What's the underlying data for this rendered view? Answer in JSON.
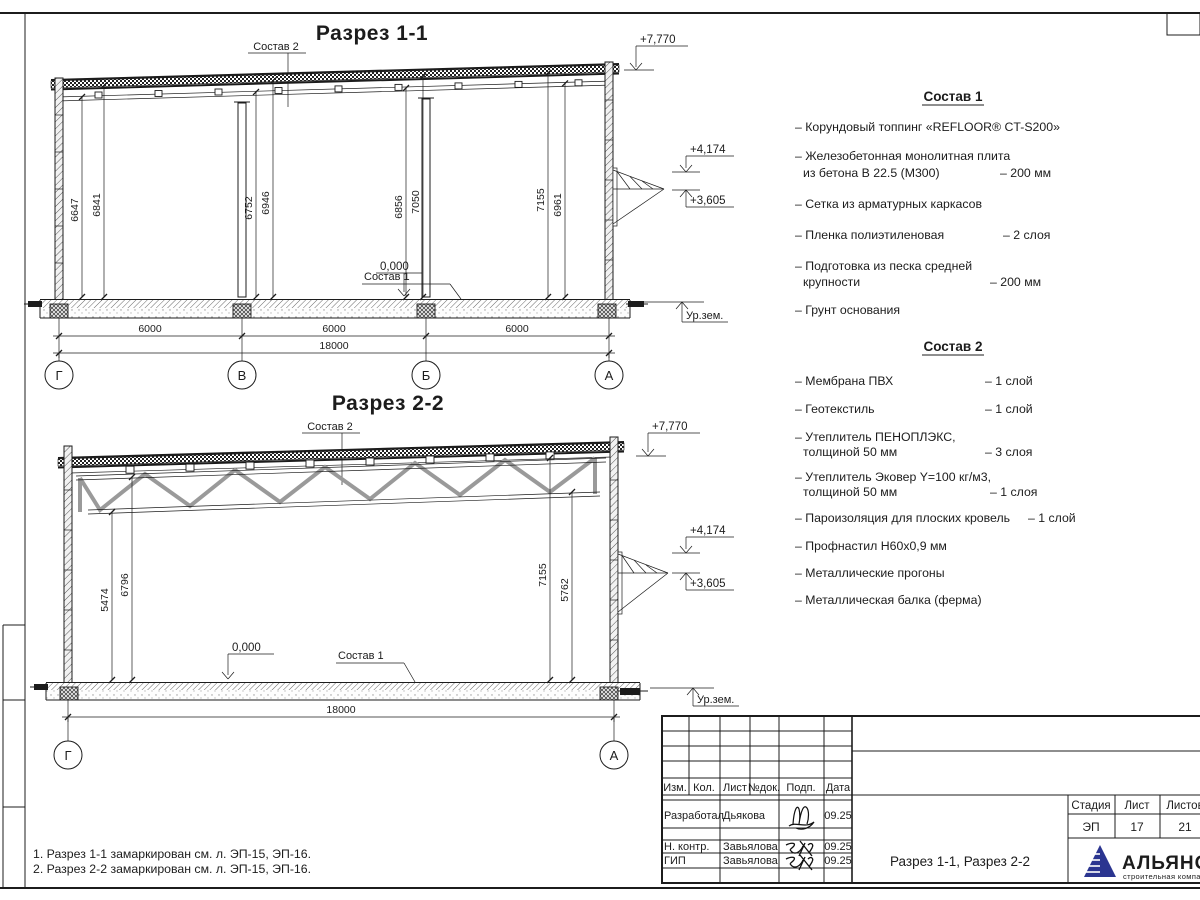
{
  "sheet": {
    "bg": "#ffffff",
    "line_color": "#1c1c1c",
    "logo_blue": "#2b3590",
    "logo_lightblue": "#3f9bd8"
  },
  "s1": {
    "title": "Разрез 1-1",
    "sostav2_label": "Состав 2",
    "sostav1_label": "Состав 1",
    "elev_roof": "+7,770",
    "elev_canopy_top": "+4,174",
    "elev_canopy_bot": "+3,605",
    "elev_zero": "0,000",
    "ground": "Ур.зем.",
    "vdims": [
      "6647",
      "6841",
      "6752",
      "6946",
      "6856",
      "7050",
      "7155",
      "6961"
    ],
    "spans": [
      "6000",
      "6000",
      "6000"
    ],
    "total": "18000",
    "axes": [
      "Г",
      "В",
      "Б",
      "А"
    ]
  },
  "s2": {
    "title": "Разрез 2-2",
    "sostav2_label": "Состав 2",
    "sostav1_label": "Состав 1",
    "elev_roof": "+7,770",
    "elev_canopy_top": "+4,174",
    "elev_canopy_bot": "+3,605",
    "elev_zero": "0,000",
    "ground": "Ур.зем.",
    "vdims": [
      "5474",
      "6796",
      "7155",
      "5762"
    ],
    "total": "18000",
    "axes": [
      "Г",
      "А"
    ]
  },
  "sostav1": {
    "title": "Состав 1",
    "items": [
      {
        "l1": "– Корундовый топпинг «REFLOOR® CT-S200»",
        "l2": "",
        "val": ""
      },
      {
        "l1": "– Железобетонная монолитная плита",
        "l2": "из бетона В 22.5 (М300)",
        "val": "– 200 мм"
      },
      {
        "l1": "– Сетка из арматурных каркасов",
        "l2": "",
        "val": ""
      },
      {
        "l1": "– Пленка полиэтиленовая",
        "l2": "",
        "val": "– 2 слоя"
      },
      {
        "l1": "– Подготовка из песка средней",
        "l2": "крупности",
        "val": "– 200 мм"
      },
      {
        "l1": "– Грунт основания",
        "l2": "",
        "val": ""
      }
    ]
  },
  "sostav2": {
    "title": "Состав 2",
    "items": [
      {
        "l1": "– Мембрана ПВХ",
        "l2": "",
        "val": "– 1 слой"
      },
      {
        "l1": "– Геотекстиль",
        "l2": "",
        "val": "– 1 слой"
      },
      {
        "l1": "– Утеплитель ПЕНОПЛЭКС,",
        "l2": "толщиной 50 мм",
        "val": "– 3 слоя"
      },
      {
        "l1": "– Утеплитель Эковер Y=100 кг/м3,",
        "l2": "толщиной 50 мм",
        "val": "– 1 слоя"
      },
      {
        "l1": "– Пароизоляция для плоских кровель",
        "l2": "",
        "val": "– 1 слой"
      },
      {
        "l1": "– Профнастил Н60х0,9 мм",
        "l2": "",
        "val": ""
      },
      {
        "l1": "– Металлические прогоны",
        "l2": "",
        "val": ""
      },
      {
        "l1": "– Металлическая балка (ферма)",
        "l2": "",
        "val": ""
      }
    ]
  },
  "notes": [
    "1. Разрез 1-1 замаркирован см. л. ЭП-15, ЭП-16.",
    "2. Разрез 2-2 замаркирован см. л. ЭП-15, ЭП-16."
  ],
  "tb": {
    "h_izm": "Изм.",
    "h_kol": "Кол.",
    "h_list": "Лист",
    "h_ndok": "№док.",
    "h_podp": "Подп.",
    "h_data": "Дата",
    "rows": [
      {
        "role": "Разработал",
        "name": "Дьякова",
        "date": "09.25"
      },
      {
        "role": "Н. контр.",
        "name": "Завьялова",
        "date": "09.25"
      },
      {
        "role": "ГИП",
        "name": "Завьялова",
        "date": "09.25"
      }
    ],
    "doc_title": "Разрез 1-1, Разрез 2-2",
    "h_stage": "Стадия",
    "h_sheet": "Лист",
    "h_sheets": "Листов",
    "stage": "ЭП",
    "sheet": "17",
    "sheets": "21",
    "logo": "АЛЬЯНС",
    "logo_sub": "строительная компания"
  }
}
